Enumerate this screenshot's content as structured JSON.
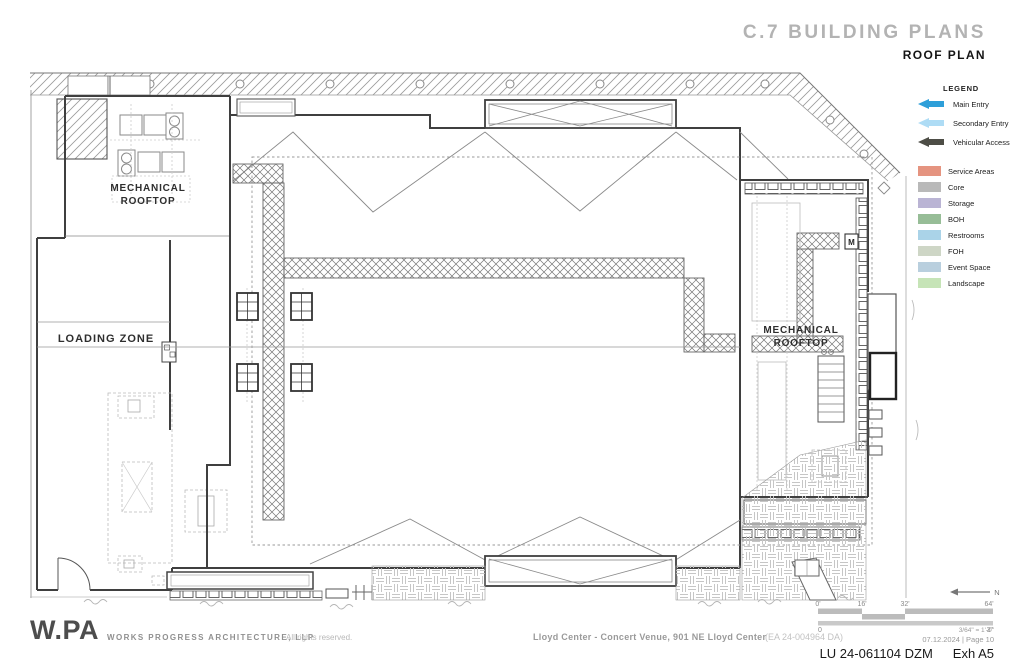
{
  "header": {
    "title": "C.7 BUILDING PLANS",
    "subtitle": "ROOF PLAN"
  },
  "legend": {
    "title": "LEGEND",
    "arrows": [
      {
        "label": "Main Entry",
        "color": "#2e9fd9"
      },
      {
        "label": "Secondary Entry",
        "color": "#aedcf5"
      },
      {
        "label": "Vehicular Access",
        "color": "#4d4d46"
      }
    ],
    "areas": [
      {
        "label": "Service Areas",
        "color": "#e59480"
      },
      {
        "label": "Core",
        "color": "#b9b9b9"
      },
      {
        "label": "Storage",
        "color": "#bab4d4"
      },
      {
        "label": "BOH",
        "color": "#97bd97"
      },
      {
        "label": "Restrooms",
        "color": "#aad3e8"
      },
      {
        "label": "FOH",
        "color": "#ced6c6"
      },
      {
        "label": "Event Space",
        "color": "#b9cfde"
      },
      {
        "label": "Landscape",
        "color": "#c6e4b7"
      }
    ]
  },
  "plan": {
    "labels": {
      "mechanical_1": "MECHANICAL",
      "mechanical_2": "ROOFTOP",
      "loading_zone": "LOADING ZONE",
      "marker_m": "M"
    }
  },
  "scale_bar": {
    "feet": [
      "0'",
      "16'",
      "32'",
      "64'"
    ],
    "inches_start": "0",
    "inches_end": "3\"",
    "ratio": "3/64\" = 1'-0\"",
    "north": "N"
  },
  "footer": {
    "logo": "W.PA",
    "firm": "WORKS PROGRESS ARCHITECTURE, LLP",
    "rights": "All rights reserved.",
    "project": "Lloyd Center - Concert Venue, 901 NE Lloyd Center",
    "case_number": "(EA 24-004964 DA)",
    "date_page": "07.12.2024   |   Page 10",
    "permit": "LU 24-061104 DZM",
    "exhibit": "Exh A5"
  }
}
